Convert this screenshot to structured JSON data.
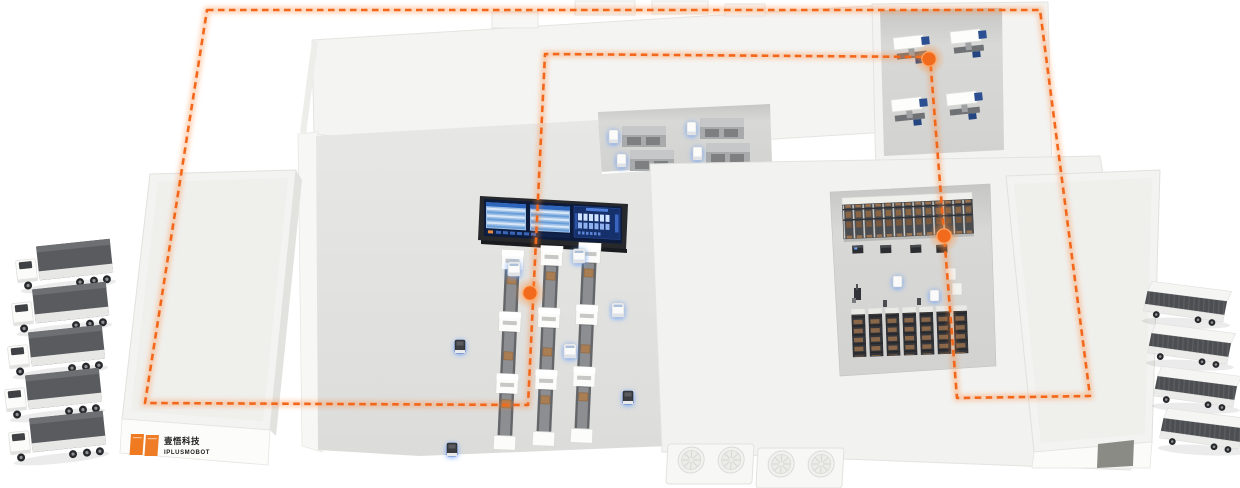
{
  "branding": {
    "logo_text_cn": "壹悟科技",
    "logo_text_en": "IPLUSMOBOT",
    "logo_color": "#F07A20"
  },
  "route": {
    "color": "#F2671A",
    "glow_color": "#FF8435",
    "style": "dashed",
    "waypoint_color": "#F26A1C",
    "waypoints": 3
  },
  "fleet": {
    "dock_trucks": 5,
    "transfer_vans": 4,
    "floor_agvs": 4,
    "compact_robots": 3
  },
  "equipment": {
    "conveyor_lines": 3,
    "units_per_line": 3,
    "workstations": 4,
    "palletizers": 4,
    "rack_rows": 2,
    "rack_bottom_units": 7,
    "rack_shuttles": 4,
    "hvac_units": 2,
    "fans_per_unit": 2
  },
  "palette": {
    "roof": "#F3F3F1",
    "recessed_floor": "#D8D8D6",
    "container_gray": "#595B5E",
    "screen_navy": "#16306B",
    "robot_glow": "#5D9BFF"
  }
}
